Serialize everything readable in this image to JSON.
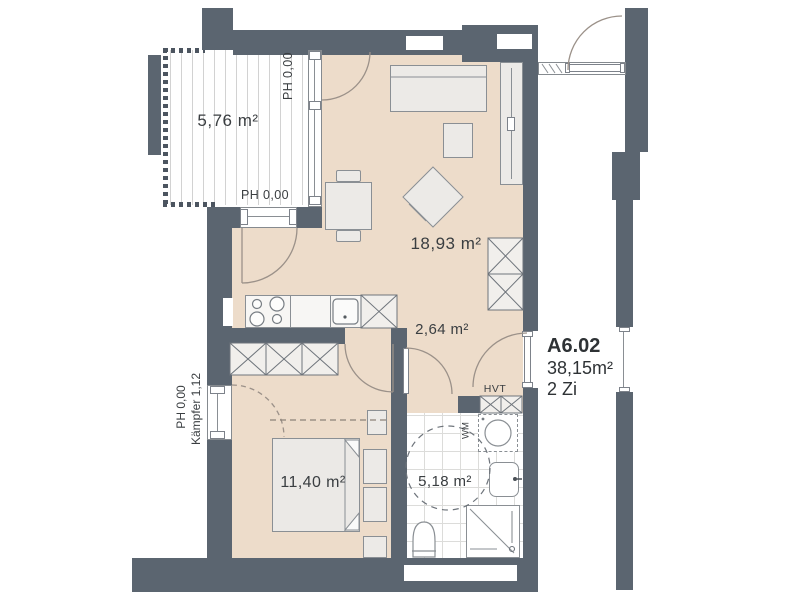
{
  "unit": {
    "id": "A6.02",
    "area": "38,15m²",
    "rooms": "2 Zi"
  },
  "labels": {
    "balcony_area": "5,76 m²",
    "balcony_ph_side": "PH 0,00",
    "balcony_ph_bottom": "PH 0,00",
    "living_area": "18,93 m²",
    "hall_area": "2,64 m²",
    "bedroom_area": "11,40 m²",
    "bath_area": "5,18 m²",
    "bedroom_window_ph": "PH 0,00",
    "bedroom_window_kaempfer": "Kämpfer 1,12",
    "hvt": "HVT",
    "washing_machine": "WM"
  },
  "colors": {
    "wall": "#5b6570",
    "floor": "#eddcca",
    "furniture_fill": "#eceae7",
    "line": "#8a8f94",
    "door_arc": "#9b9189",
    "text": "#3a3e41"
  }
}
